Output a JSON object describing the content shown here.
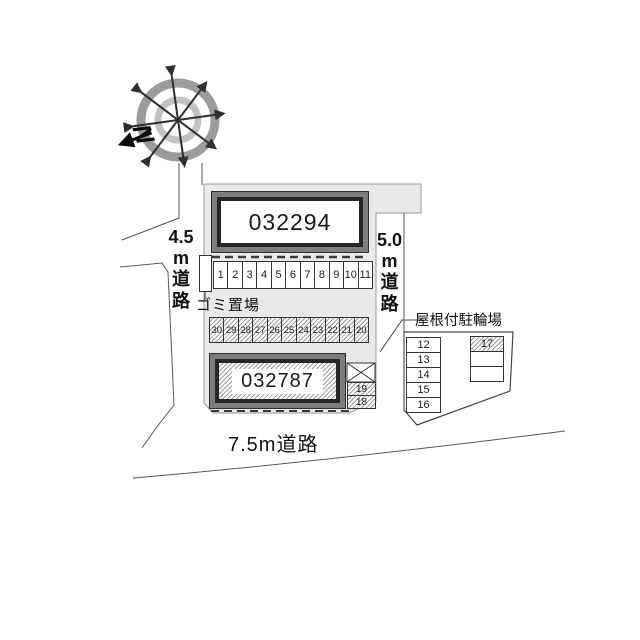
{
  "compass": {
    "north_label": "N"
  },
  "roads": {
    "west": [
      "4.5",
      "m",
      "道",
      "路"
    ],
    "east": [
      "5.0",
      "m",
      "道",
      "路"
    ],
    "south": "7.5m道路"
  },
  "buildings": {
    "upper": "032294",
    "lower": "032787"
  },
  "labels": {
    "garbage": "ゴミ置場",
    "bike_parking": "屋根付駐輪場"
  },
  "parking": {
    "row_top": [
      "1",
      "2",
      "3",
      "4",
      "5",
      "6",
      "7",
      "8",
      "9",
      "10",
      "11"
    ],
    "row_middle": [
      "30",
      "29",
      "28",
      "27",
      "26",
      "25",
      "24",
      "23",
      "22",
      "21",
      "20"
    ],
    "side_cells": [
      "19",
      "18"
    ],
    "right_column": [
      "12",
      "13",
      "14",
      "15",
      "16"
    ],
    "bike_cell": "17"
  },
  "colors": {
    "parcel_fill": "#e9e9e9",
    "building_band": "#7d7d7d",
    "building_frame": "#262626",
    "line": "#3a3a3a",
    "hatch_line": "#9b9b9b"
  }
}
